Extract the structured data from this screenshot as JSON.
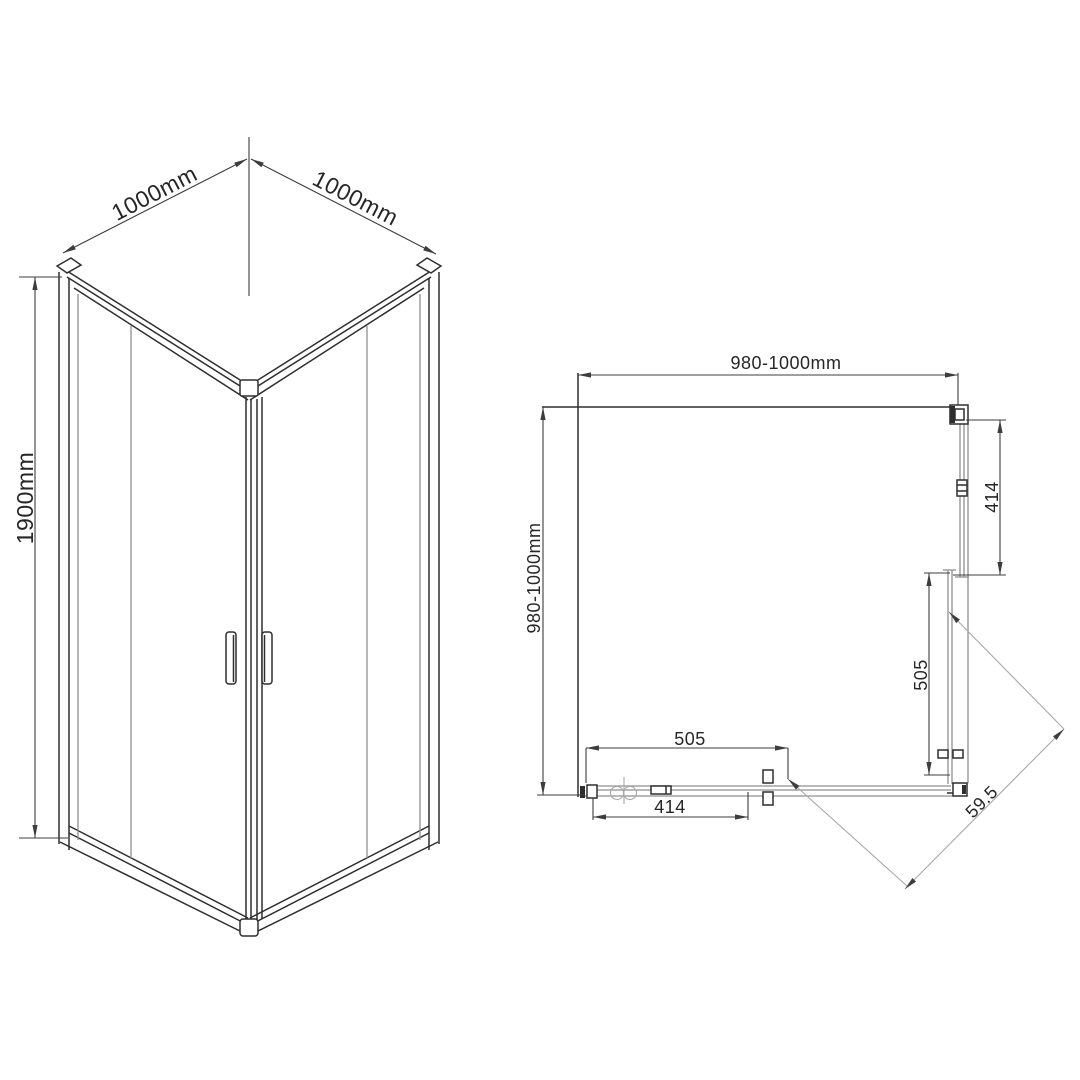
{
  "drawing": {
    "type": "corner-shower-enclosure-technical-drawing",
    "iso": {
      "dim_top_left": "1000mm",
      "dim_top_right": "1000mm",
      "dim_height": "1900mm"
    },
    "plan": {
      "dim_top": "980-1000mm",
      "dim_left": "980-1000mm",
      "dim_right_outer": "414",
      "dim_right_inner": "505",
      "dim_bottom_inner": "505",
      "dim_bottom_outer": "414",
      "dim_diagonal": "59.5"
    },
    "colors": {
      "background": "#ffffff",
      "object_line": "#2e2e2e",
      "dim_line": "#3d3d3d",
      "glass_line": "#8f8f8f",
      "light_line": "#a9a9a9",
      "text": "#262626"
    }
  }
}
